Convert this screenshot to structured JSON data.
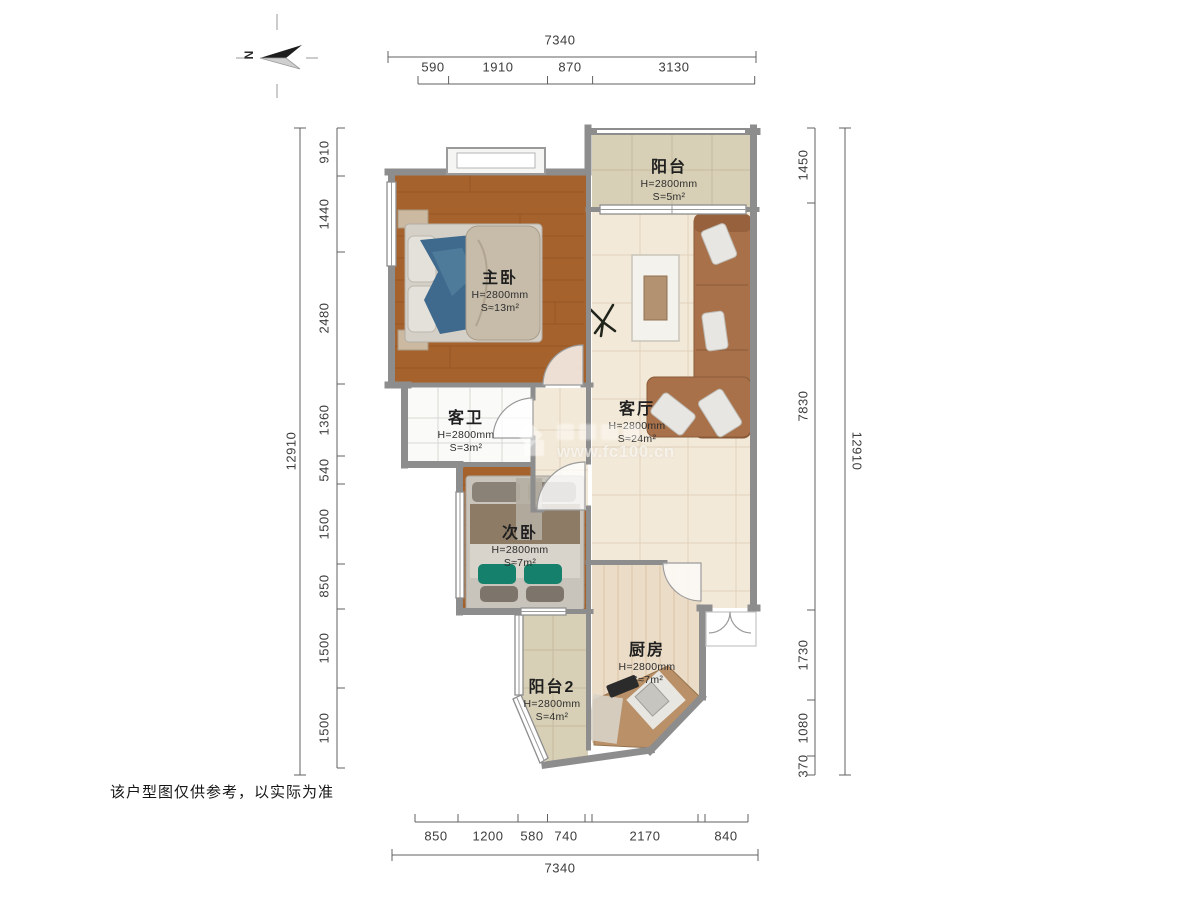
{
  "disclaimer": "该户型图仅供参考，以实际为准",
  "compass": {
    "north_label": "N"
  },
  "watermark": {
    "site": "www.fc100.cn"
  },
  "rooms": [
    {
      "key": "balcony",
      "name": "阳台",
      "ceiling": "H=2800mm",
      "area": "S=5m²"
    },
    {
      "key": "master-bedroom",
      "name": "主卧",
      "ceiling": "H=2800mm",
      "area": "S≈13m²"
    },
    {
      "key": "living-room",
      "name": "客厅",
      "ceiling": "H=2800mm",
      "area": "S≈24m²"
    },
    {
      "key": "guest-bathroom",
      "name": "客卫",
      "ceiling": "H=2800mm",
      "area": "S=3m²"
    },
    {
      "key": "second-bedroom",
      "name": "次卧",
      "ceiling": "H=2800mm",
      "area": "S≈7m²"
    },
    {
      "key": "kitchen",
      "name": "厨房",
      "ceiling": "H=2800mm",
      "area": "S≈7m²"
    },
    {
      "key": "balcony-2",
      "name": "阳台2",
      "ceiling": "H=2800mm",
      "area": "S=4m²"
    }
  ],
  "dimensions": {
    "top": {
      "total": "7340",
      "segments": [
        "590",
        "1910",
        "870",
        "3130"
      ]
    },
    "bottom": {
      "total": "7340",
      "segments": [
        "850",
        "1200",
        "580",
        "740",
        "2170",
        "840"
      ]
    },
    "left": {
      "total": "12910",
      "segments": [
        "910",
        "1440",
        "2480",
        "1360",
        "540",
        "1500",
        "850",
        "1500",
        "1500"
      ]
    },
    "right": {
      "total": "12910",
      "segments": [
        "1450",
        "7830",
        "1730",
        "1080",
        "370"
      ]
    }
  },
  "colors": {
    "wall": "#8d8d8d",
    "wood_floor": "#a6622c",
    "tile_light": "#f3e9d8",
    "tile_balcony": "#d8d0b6",
    "kitchen_floor": "#ebdcc8",
    "bath_floor": "#fafaf8",
    "sofa": "#a8714a",
    "bed_blanket_blue": "#3f6a8d",
    "pillow_green": "#15806b",
    "counter": "#b99068",
    "dim_text": "#3c3c3c"
  }
}
